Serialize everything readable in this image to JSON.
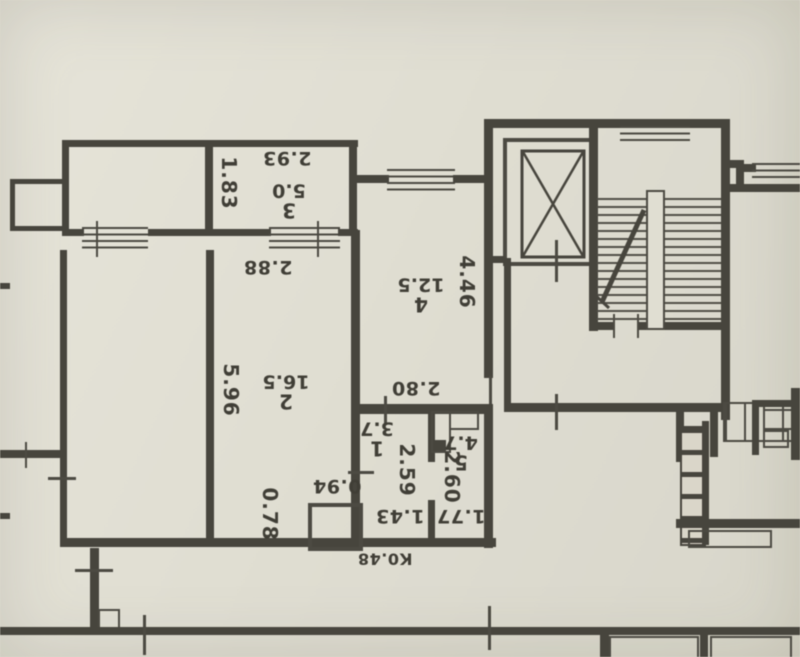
{
  "document": {
    "type": "floor-plan-scan",
    "orientation": "text rotated 180 degrees (photo upside-down)",
    "colors": {
      "paper": "#e3e1d5",
      "ink": "#45433b"
    }
  },
  "rooms": {
    "room1": {
      "number": "1",
      "area": "3.7"
    },
    "room2": {
      "number": "2",
      "area": "16.5"
    },
    "room3": {
      "number": "3",
      "area": "5.0"
    },
    "room4": {
      "number": "4",
      "area": "12.5"
    },
    "room5": {
      "number": "5",
      "area": "4.7"
    }
  },
  "dimensions": {
    "d293": "2.93",
    "d183": "1.83",
    "d288": "2.88",
    "d596": "5.96",
    "d446": "4.46",
    "d280": "2.80",
    "d094": "0.94",
    "d078": "0.78",
    "d259": "2.59",
    "d143": "1.43",
    "d260": "2.60",
    "d177": "1.77",
    "duct": "К0.48"
  },
  "features": {
    "elevator": "elevator-shaft",
    "staircase": "staircase",
    "windows": "hatched-window",
    "vent_block": "ventilation-shafts"
  }
}
